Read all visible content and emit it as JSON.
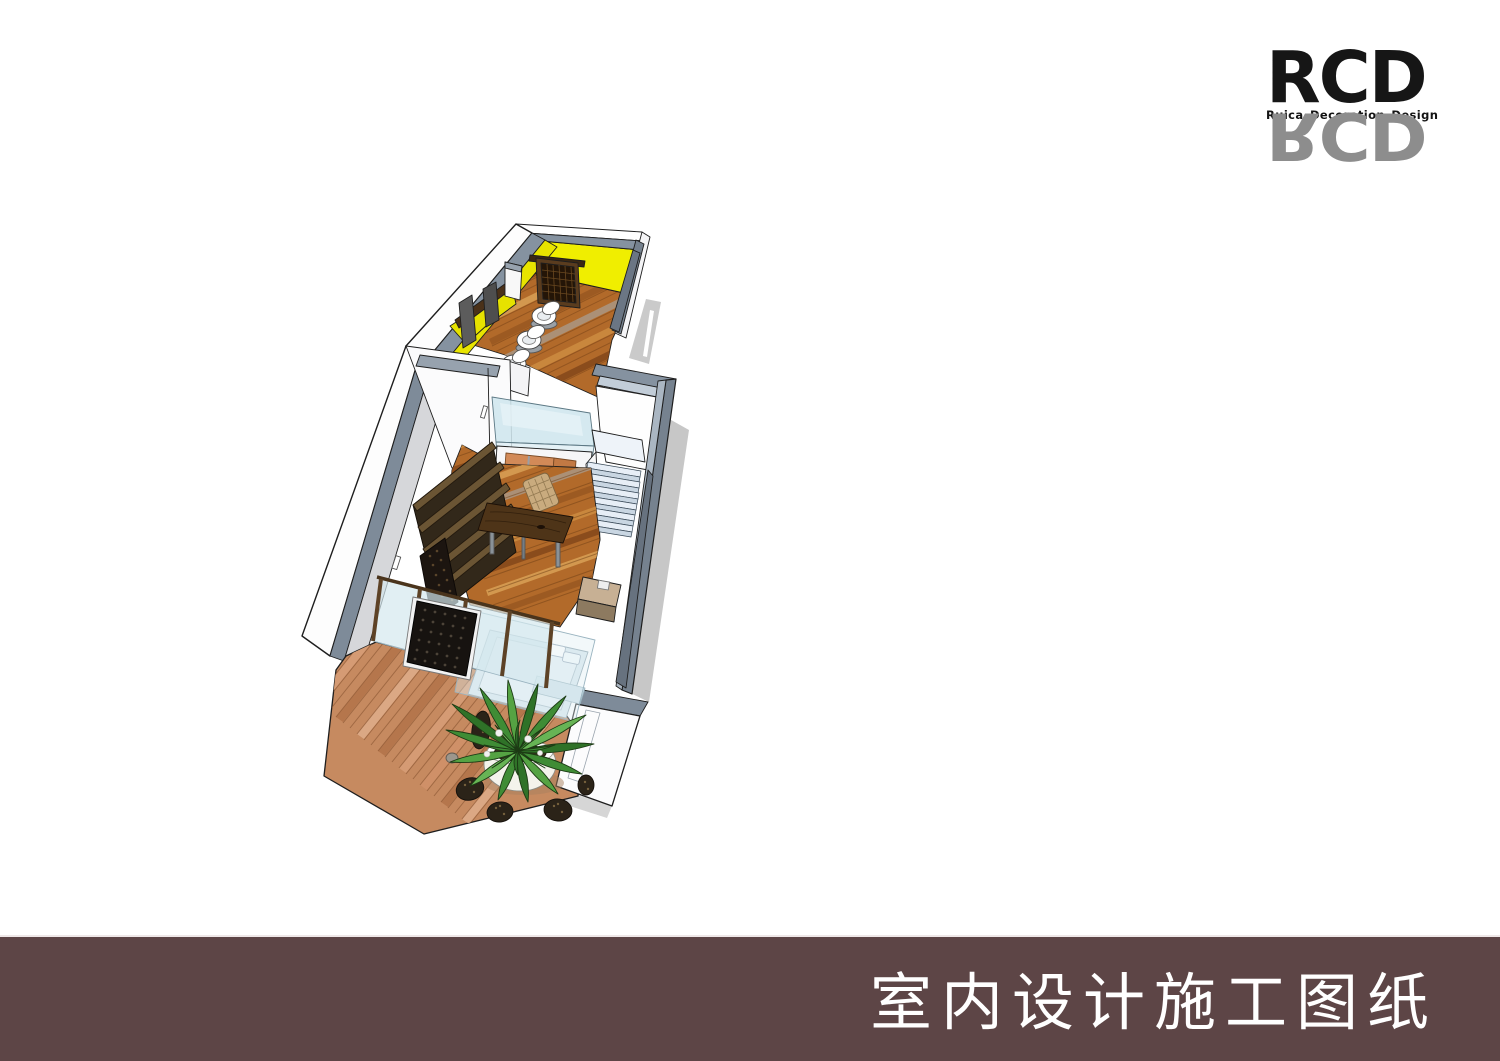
{
  "page": {
    "width": 1500,
    "height": 1061,
    "background": "#ffffff"
  },
  "brand": {
    "name": "RCD",
    "tagline": "Ruica Decoration Design",
    "colors": {
      "primary": "#161616",
      "reflection": "#8d8d8d"
    }
  },
  "footer": {
    "title": "室内设计施工图纸",
    "bar_color": "#5d4546",
    "text_color": "#ffffff"
  },
  "illustration": {
    "type": "3d-interior-cutaway-rendering",
    "style": "SketchUp-like aerial axonometric with black edge lines and soft drop shadows",
    "rooms": [
      {
        "name": "bathroom",
        "wall_color": "#f0ee00",
        "floor": "orange wood planks",
        "contents": [
          "three white toilets in a row",
          "dark carved wood lattice screen",
          "vanity counter with two leaning dark mirrors"
        ]
      },
      {
        "name": "living-dining",
        "wall_colors": [
          "#ffffff",
          "#d6d7da"
        ],
        "contents": [
          "dark wood wall shelving with lattice wine rack",
          "live-edge walnut dining table",
          "rattan chair",
          "wardrobe with orange double doors",
          "glass display box",
          "pale blue staircase",
          "tan bench"
        ]
      },
      {
        "name": "bedroom",
        "contents": [
          "glass partition with dark pebble-lattice art panel",
          "bed with pale blue bedding and pillows"
        ]
      },
      {
        "name": "deck",
        "contents": [
          "pink-brown wood decking",
          "agave plant in round white pot",
          "dark pebble clusters"
        ]
      }
    ],
    "palette": {
      "wall_top_gray": "#7e8b99",
      "wall_interior_gray": "#d6d7da",
      "wall_white": "#fdfdfd",
      "yellow_wall": "#f0ee00",
      "interior_wood": "#b26a2a",
      "deck_wood": "#c68a60",
      "dark_wood": "#43301c",
      "door_orange": "#d28a58",
      "glass": "#cfe6ee",
      "stairs": "#e7eef6",
      "bed": "#d9e8ee",
      "plant_green": "#3f8c35",
      "shadow": "#c7c7c7",
      "pebble": "#2b2318"
    }
  }
}
